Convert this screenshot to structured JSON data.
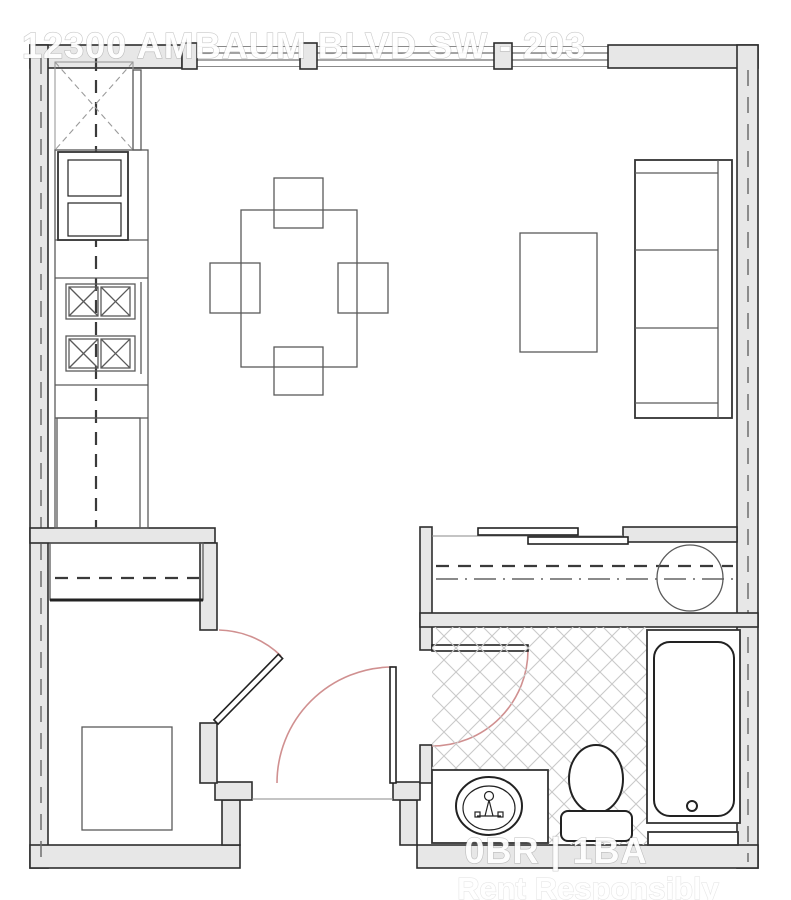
{
  "watermarks": {
    "address": "12300 AMBAUM BLVD SW - 203",
    "unit_specs": "0BR | 1BA",
    "tagline": "Rent Responsibly"
  },
  "colors": {
    "background": "#ffffff",
    "wall_fill": "#e7e7e7",
    "wall_stroke": "#2e2e2e",
    "furniture_stroke": "#5a5a5a",
    "fixture_stroke": "#222222",
    "door_arc": "#d09090",
    "hatch_line": "#c9c9c9",
    "dashed_line": "#3a3a3a",
    "watermark_text": "#ffffff"
  }
}
